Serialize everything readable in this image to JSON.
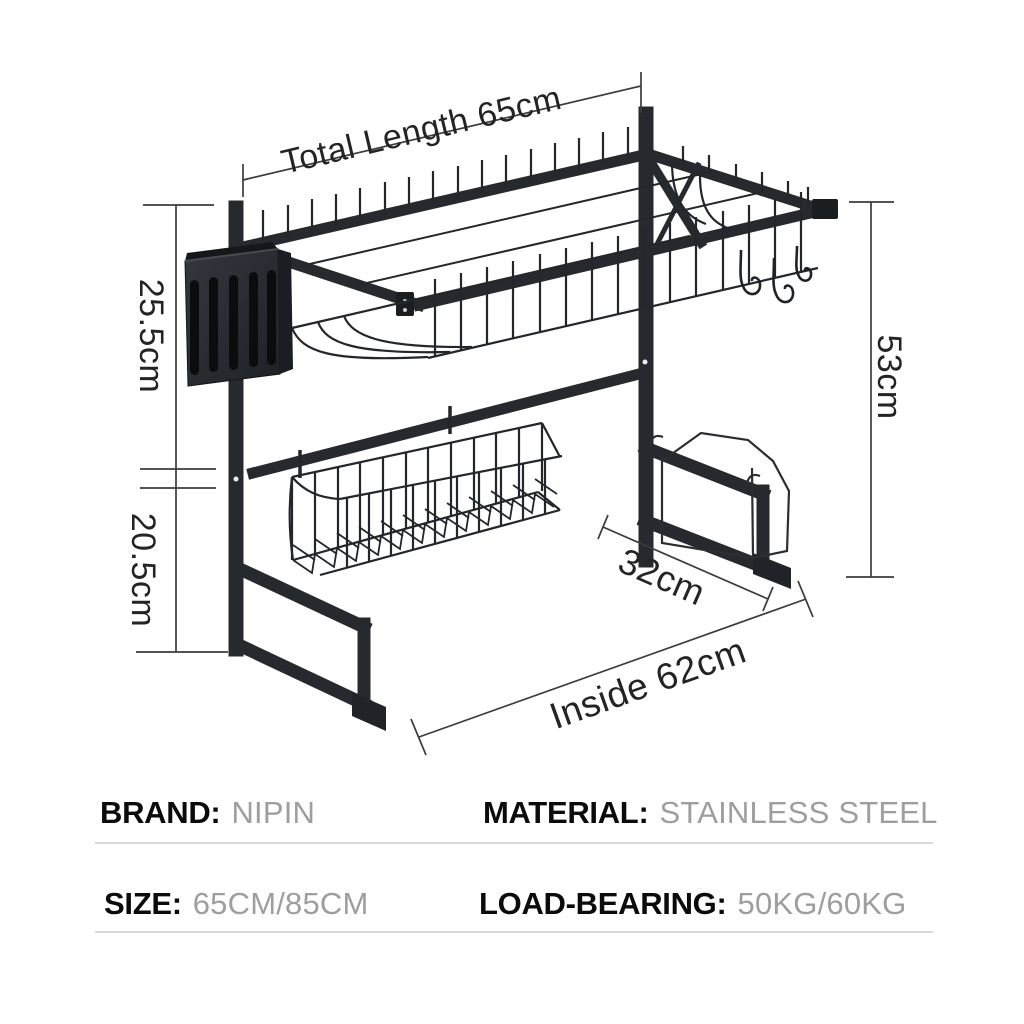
{
  "diagram": {
    "dimensions": {
      "total_length": "Total Length 65cm",
      "upper_section_height": "25.5cm",
      "lower_section_height": "20.5cm",
      "overall_height": "53cm",
      "depth": "32cm",
      "inside_length": "Inside 62cm"
    }
  },
  "specs": [
    {
      "label": "BRAND:",
      "value": "NIPIN"
    },
    {
      "label": "MATERIAL:",
      "value": "STAINLESS STEEL"
    },
    {
      "label": "SIZE:",
      "value": "65CM/85CM"
    },
    {
      "label": "LOAD-BEARING:",
      "value": "50KG/60KG"
    }
  ],
  "colors": {
    "background": "#ffffff",
    "rack_metal": "#26292d",
    "dimension_line": "#3c3c3c",
    "dimension_text": "#242424",
    "spec_label": "#0b0b0b",
    "spec_value": "#9e9e9e",
    "divider": "#d9d9d9"
  }
}
